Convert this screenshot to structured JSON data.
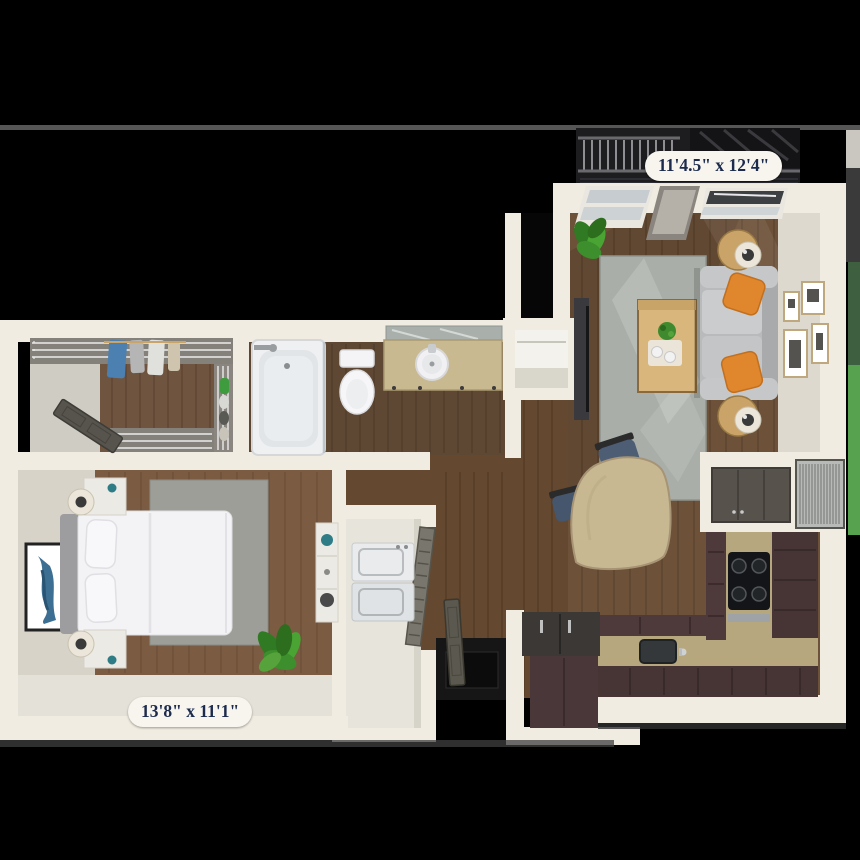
{
  "scene": {
    "background_color": "#000000",
    "horizon_line_color": "#565656",
    "exterior_green_color": "#57a24e"
  },
  "labels": {
    "living_room_dimensions": "11'4.5\" x 12'4\"",
    "bedroom_dimensions": "13'8\" x 11'1\""
  },
  "palette": {
    "wall": "#f0ece1",
    "wall_face": "#d9d5cb",
    "living_wood_floor": "#6d5138",
    "bathroom_wood_floor": "#5e4733",
    "bedroom_wood_floor": "#7b5c43",
    "living_rug": "#a9aea8",
    "bedroom_rug": "#9e9e98",
    "sofa_gray": "#b9babc",
    "pillow_orange": "#e0862c",
    "kitchen_cabinet_brown": "#473536",
    "granite_counter_tan": "#b7a77f",
    "appliance_black": "#17181a",
    "bed_white": "#f2f2f4",
    "label_text": "#1c2b4d",
    "label_pill": "#f7f5ee"
  },
  "rooms": [
    "balcony",
    "living-room",
    "dining-area",
    "kitchen",
    "entry",
    "laundry-closet",
    "bathroom",
    "walk-in-closet",
    "bedroom",
    "coat-closet",
    "hvac-niche"
  ],
  "furniture": [
    "balcony-railing",
    "sliding-windows",
    "sofa",
    "orange-throw-pillows",
    "side-tables-with-lamps",
    "coffee-table",
    "living-area-rug",
    "tv-console",
    "gallery-wall-frames",
    "potted-plant",
    "dining-table",
    "dining-chairs",
    "kitchen-l-counter",
    "kitchen-sink",
    "cooktop",
    "upper-cabinets",
    "hvac-unit",
    "kitchen-island",
    "entry-door",
    "stacked-washer-dryer",
    "louver-door",
    "bathtub-shower",
    "toilet",
    "vanity-with-sink",
    "mirror",
    "wire-shelving",
    "hanging-clothes",
    "closet-door",
    "bed",
    "headboard",
    "nightstands",
    "table-lamps",
    "wall-art",
    "bedroom-rug",
    "dresser",
    "bedroom-plant"
  ]
}
